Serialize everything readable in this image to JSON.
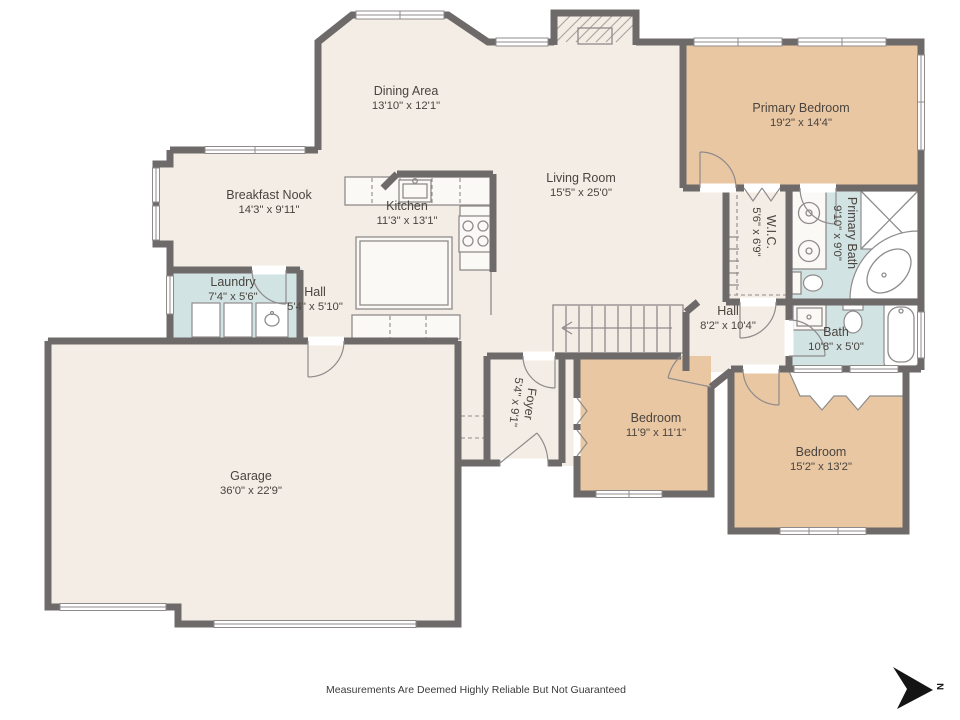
{
  "palette": {
    "wall": "#6e6a6a",
    "floor": "#f3ede6",
    "bedroom": "#e9c7a3",
    "bath": "#d2e3e4",
    "counter": "#fbf9f6",
    "fixture": "#8f8b8b",
    "label": "#4a443e"
  },
  "rooms": [
    {
      "name": "Dining Area",
      "dims": "13'10\" x 12'1\""
    },
    {
      "name": "Primary Bedroom",
      "dims": "19'2\" x 14'4\""
    },
    {
      "name": "Breakfast Nook",
      "dims": "14'3\" x 9'11\""
    },
    {
      "name": "Kitchen",
      "dims": "11'3\" x 13'1\""
    },
    {
      "name": "Living Room",
      "dims": "15'5\" x 25'0\""
    },
    {
      "name": "Laundry",
      "dims": "7'4\" x 5'6\""
    },
    {
      "name": "Hall",
      "dims": "5'4\" x 5'10\""
    },
    {
      "name": "W.I.C.",
      "dims": "5'6\" x 6'9\""
    },
    {
      "name": "Primary Bath",
      "dims": "9'10\" x 9'0\""
    },
    {
      "name": "Hall",
      "dims": "8'2\" x 10'4\""
    },
    {
      "name": "Bath",
      "dims": "10'8\" x 5'0\""
    },
    {
      "name": "Foyer",
      "dims": "5'4\" x 9'1\""
    },
    {
      "name": "Bedroom",
      "dims": "11'9\" x 11'1\""
    },
    {
      "name": "Bedroom",
      "dims": "15'2\" x 13'2\""
    },
    {
      "name": "Garage",
      "dims": "36'0\" x 22'9\""
    }
  ],
  "footer": {
    "disclaimer": "Measurements Are Deemed Highly Reliable But Not Guaranteed"
  },
  "compass": {
    "label": "N"
  }
}
